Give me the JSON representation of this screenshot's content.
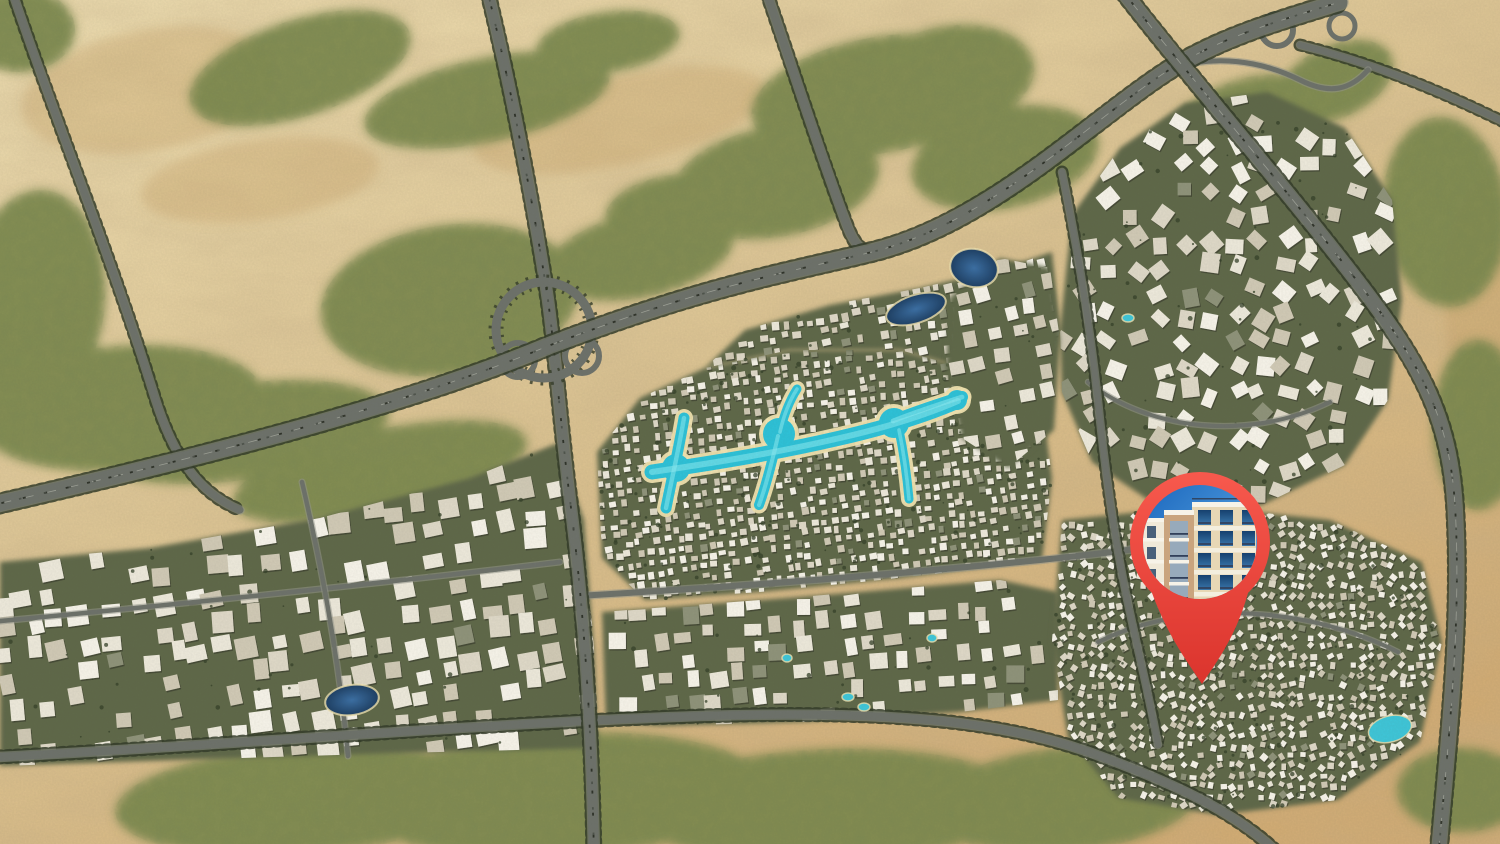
{
  "scene": {
    "width": 1500,
    "height": 844,
    "kind": "aerial-masterplan-map-with-location-pin"
  },
  "palette": {
    "sand_light": "#ecdcb0",
    "sand": "#dcc493",
    "sand_deep": "#d0ab74",
    "dune_shadow": "#c19a64",
    "veg": "#7e8a50",
    "veg_dark": "#55633a",
    "tree": "#36422a",
    "ground": "#5f6849",
    "road": "#6d716a",
    "road_edge": "#93968b",
    "treeline": "#343c29",
    "lane": "#c2c4b8",
    "traffic_a": "#24281f",
    "traffic_b": "#4a4f46",
    "bldg": [
      "#f4f1e7",
      "#ebe7d9",
      "#ddd7c6",
      "#cfc8b4"
    ],
    "bldg_dark": "#8e9279",
    "lagoon": "#2ec0d6",
    "lagoon_light": "#8ceaf0",
    "beach": "#eee0ae",
    "pool": "#3fc4d6",
    "pin_top": "#f7594d",
    "pin_bottom": "#da332c"
  },
  "marker": {
    "name": "project-location-pin",
    "head_cx": 1200,
    "head_cy": 542,
    "head_r": 70,
    "photo_r": 57,
    "tail_tip_x": 1202,
    "tail_tip_y": 684,
    "photo": {
      "subject": "beige-apartment-building-photo",
      "sky_top": "#1a66bd",
      "sky_bottom": "#6ab6ec",
      "facade": "#e7d7b5",
      "facade_light": "#f0e9d8",
      "band": "#f3eede",
      "portal": "#c9a47e",
      "opening": "#97aabb",
      "window_top": "#16406e",
      "window_bottom": "#3a77ab",
      "rail": "#31405a",
      "parapet": "#f7f3e8",
      "side_window": "#49607a"
    }
  },
  "terrain": {
    "green_patches": [
      [
        120,
        408,
        145,
        62,
        -5
      ],
      [
        35,
        300,
        70,
        110,
        5
      ],
      [
        300,
        68,
        115,
        48,
        -18
      ],
      [
        487,
        100,
        125,
        42,
        -12
      ],
      [
        608,
        42,
        72,
        30,
        -8
      ],
      [
        950,
        78,
        85,
        52,
        -10
      ],
      [
        880,
        95,
        130,
        58,
        -10
      ],
      [
        775,
        182,
        105,
        55,
        -10
      ],
      [
        1005,
        158,
        95,
        50,
        -12
      ],
      [
        680,
        212,
        75,
        38,
        -6
      ],
      [
        640,
        255,
        95,
        42,
        -12
      ],
      [
        450,
        300,
        130,
        75,
        -8
      ],
      [
        240,
        432,
        150,
        48,
        -8
      ],
      [
        380,
        472,
        150,
        42,
        -12
      ],
      [
        1245,
        128,
        85,
        48,
        -20
      ],
      [
        1335,
        82,
        62,
        36,
        -25
      ],
      [
        1200,
        200,
        70,
        45,
        -20
      ],
      [
        1445,
        212,
        62,
        95,
        -5
      ],
      [
        1478,
        425,
        45,
        85,
        0
      ],
      [
        300,
        800,
        185,
        55,
        -4
      ],
      [
        560,
        795,
        205,
        62,
        -3
      ],
      [
        830,
        806,
        195,
        57,
        -2
      ],
      [
        1065,
        800,
        135,
        52,
        -5
      ],
      [
        90,
        692,
        65,
        32,
        0
      ],
      [
        1462,
        790,
        65,
        42,
        0
      ],
      [
        20,
        30,
        55,
        42,
        0
      ]
    ],
    "dune_shadows": [
      [
        620,
        120,
        150,
        45,
        -12
      ],
      [
        260,
        180,
        120,
        40,
        -8
      ],
      [
        1485,
        300,
        40,
        120,
        0
      ],
      [
        150,
        90,
        130,
        60,
        -10
      ]
    ]
  },
  "roads": [
    {
      "id": "west-local-road",
      "d": "M -10 622 C 150 607, 350 587, 560 562",
      "w": 4.5,
      "t": 0,
      "tr": 0,
      "c": 0
    },
    {
      "id": "west-cross-road",
      "d": "M 302 482 C 320 560, 338 650, 348 756",
      "w": 4.5,
      "t": 0,
      "tr": 0,
      "c": 0
    },
    {
      "id": "east-ring-local",
      "d": "M 1088 382 C 1148 430, 1248 442, 1330 402",
      "w": 4,
      "t": 0,
      "tr": 0,
      "c": 0
    },
    {
      "id": "southeast-local",
      "d": "M 1098 642 C 1178 602, 1298 602, 1398 652",
      "w": 4,
      "t": 0,
      "tr": 0,
      "c": 0
    },
    {
      "id": "central-avenue",
      "d": "M 578 596 C 750 586, 900 574, 1040 560 C 1108 553, 1168 546, 1228 533",
      "w": 6,
      "t": 0,
      "tr": 0,
      "c": 0
    },
    {
      "id": "east-connector",
      "d": "M 1062 172 C 1080 260, 1092 340, 1100 420 C 1108 495, 1118 560, 1132 622 C 1142 668, 1150 700, 1158 745",
      "w": 6,
      "t": 1,
      "tr": 0,
      "c": 0
    },
    {
      "id": "boundary-road-south",
      "d": "M -20 758 C 250 744, 470 724, 700 716 C 900 710, 1012 722, 1105 758 C 1185 788, 1245 818, 1285 860",
      "w": 8,
      "t": 1,
      "tr": 0,
      "c": 0
    },
    {
      "id": "desert-road-northwest",
      "d": "M 10 -15 C 55 120, 112 258, 155 398 C 172 452, 196 492, 240 510",
      "w": 7,
      "t": 1,
      "tr": 0,
      "c": 0
    },
    {
      "id": "axis-road-north",
      "d": "M 764 -15 C 790 60, 822 160, 848 228 C 855 245, 862 252, 872 252",
      "w": 8,
      "t": 1,
      "tr": 0,
      "c": 0
    },
    {
      "id": "axis-road-interchange",
      "d": "M 486 -15 C 512 90, 536 220, 548 300 C 556 360, 560 420, 570 500 C 584 610, 592 730, 594 860",
      "w": 10,
      "t": 1,
      "tr": 1,
      "c": 0
    },
    {
      "id": "northeast-spur",
      "d": "M 1300 45 C 1380 65, 1450 95, 1520 130",
      "w": 6,
      "t": 1,
      "tr": 0,
      "c": 0
    },
    {
      "id": "ring-road-north",
      "d": "M -20 508 C 180 462, 400 408, 548 346 C 705 286, 790 272, 872 252 C 990 223, 1090 120, 1172 68 C 1225 36, 1275 22, 1340 2",
      "w": 15,
      "t": 1,
      "tr": 1,
      "c": 1
    },
    {
      "id": "highway-east",
      "d": "M 1118 -15 C 1198 88, 1298 202, 1370 298 C 1430 378, 1450 430, 1455 505 C 1462 625, 1448 742, 1438 860",
      "w": 13,
      "t": 1,
      "tr": 1,
      "c": 1
    }
  ],
  "interchanges": {
    "ring": {
      "cx": 544,
      "cy": 330,
      "r": 48,
      "w": 9
    },
    "loops": [
      {
        "cx": 518,
        "cy": 360,
        "r": 17,
        "w": 6
      },
      {
        "cx": 582,
        "cy": 356,
        "r": 17,
        "w": 6
      },
      {
        "cx": 1277,
        "cy": 30,
        "r": 16,
        "w": 6
      },
      {
        "cx": 1342,
        "cy": 26,
        "r": 13,
        "w": 5
      }
    ],
    "ramps": [
      {
        "id": "northeast-ramp",
        "d": "M 1172 68 C 1215 55, 1260 60, 1300 80 C 1330 95, 1350 90, 1368 70",
        "w": 5
      }
    ]
  },
  "districts": [
    {
      "id": "west-apartments",
      "seed": 11,
      "rot": -9,
      "spacing": 27,
      "size": [
        12,
        22
      ],
      "skip": 0.22,
      "trees": 0.8,
      "poly": [
        [
          0,
          562
        ],
        [
          150,
          548
        ],
        [
          320,
          518
        ],
        [
          470,
          478
        ],
        [
          558,
          443
        ],
        [
          584,
          520
        ],
        [
          594,
          648
        ],
        [
          598,
          748
        ],
        [
          400,
          753
        ],
        [
          180,
          760
        ],
        [
          0,
          766
        ]
      ]
    },
    {
      "id": "central-lagoon-villas",
      "seed": 22,
      "rot": -7,
      "spacing": 10.5,
      "size": [
        4.5,
        7.5
      ],
      "skip": 0.14,
      "trees": 0.5,
      "poly": [
        [
          597,
          452
        ],
        [
          640,
          398
        ],
        [
          705,
          368
        ],
        [
          790,
          350
        ],
        [
          900,
          350
        ],
        [
          1000,
          378
        ],
        [
          1042,
          402
        ],
        [
          1052,
          478
        ],
        [
          1042,
          560
        ],
        [
          900,
          578
        ],
        [
          760,
          592
        ],
        [
          645,
          600
        ],
        [
          602,
          558
        ]
      ]
    },
    {
      "id": "north-strip-villas",
      "seed": 77,
      "rot": -9,
      "spacing": 12,
      "size": [
        5,
        9
      ],
      "skip": 0.25,
      "trees": 0.6,
      "poly": [
        [
          705,
          368
        ],
        [
          745,
          330
        ],
        [
          830,
          305
        ],
        [
          920,
          288
        ],
        [
          1005,
          268
        ],
        [
          1052,
          252
        ],
        [
          1060,
          330
        ],
        [
          1042,
          402
        ],
        [
          1000,
          378
        ],
        [
          900,
          350
        ],
        [
          790,
          350
        ]
      ]
    },
    {
      "id": "south-central-apartments",
      "seed": 33,
      "rot": -5,
      "spacing": 23,
      "size": [
        10,
        18
      ],
      "skip": 0.25,
      "trees": 0.9,
      "poly": [
        [
          602,
          612
        ],
        [
          800,
          597
        ],
        [
          1000,
          580
        ],
        [
          1058,
          592
        ],
        [
          1058,
          700
        ],
        [
          960,
          712
        ],
        [
          800,
          722
        ],
        [
          660,
          726
        ],
        [
          606,
          722
        ]
      ]
    },
    {
      "id": "east-apartments",
      "seed": 44,
      "rot": 0,
      "scatter": true,
      "spacing": 25,
      "size": [
        11,
        20
      ],
      "skip": 0.2,
      "trees": 1.0,
      "poly": [
        [
          1060,
          330
        ],
        [
          1072,
          215
        ],
        [
          1120,
          148
        ],
        [
          1185,
          103
        ],
        [
          1268,
          92
        ],
        [
          1345,
          128
        ],
        [
          1392,
          200
        ],
        [
          1402,
          300
        ],
        [
          1388,
          400
        ],
        [
          1345,
          465
        ],
        [
          1262,
          505
        ],
        [
          1160,
          508
        ],
        [
          1092,
          462
        ],
        [
          1062,
          392
        ]
      ]
    },
    {
      "id": "business-cluster",
      "seed": 55,
      "rot": -12,
      "spacing": 21,
      "size": [
        10,
        16
      ],
      "skip": 0.3,
      "trees": 1.1,
      "poly": [
        [
          950,
          298
        ],
        [
          1000,
          258
        ],
        [
          1050,
          268
        ],
        [
          1060,
          340
        ],
        [
          1054,
          430
        ],
        [
          1008,
          468
        ],
        [
          962,
          438
        ],
        [
          946,
          368
        ]
      ]
    },
    {
      "id": "southeast-villas",
      "seed": 66,
      "rot": 0,
      "scatter": true,
      "spacing": 10,
      "size": [
        4.5,
        7
      ],
      "skip": 0.12,
      "trees": 0.5,
      "poly": [
        [
          1062,
          520
        ],
        [
          1200,
          506
        ],
        [
          1330,
          520
        ],
        [
          1422,
          562
        ],
        [
          1442,
          642
        ],
        [
          1420,
          742
        ],
        [
          1338,
          800
        ],
        [
          1218,
          815
        ],
        [
          1118,
          798
        ],
        [
          1068,
          738
        ],
        [
          1052,
          640
        ]
      ]
    }
  ],
  "water": {
    "lagoon_paths": [
      {
        "d": "M 652 472 C 720 462, 780 452, 840 438 C 888 427, 928 414, 958 401",
        "w": 15
      },
      {
        "d": "M 684 418 C 679 448, 672 478, 666 508",
        "w": 11
      },
      {
        "d": "M 778 436 C 772 462, 766 486, 759 505",
        "w": 10
      },
      {
        "d": "M 780 432 C 784 414, 790 400, 797 389",
        "w": 9
      },
      {
        "d": "M 893 421 C 915 412, 940 404, 962 397",
        "w": 12
      },
      {
        "d": "M 899 430 C 904 454, 907 477, 909 499",
        "w": 9
      }
    ],
    "lagoon_pools": [
      [
        676,
        468,
        14
      ],
      [
        779,
        434,
        16
      ],
      [
        894,
        423,
        15
      ],
      [
        957,
        400,
        10
      ]
    ],
    "lakes": [
      {
        "cx": 974,
        "cy": 268,
        "rx": 24,
        "ry": 19,
        "rot": 12
      },
      {
        "cx": 916,
        "cy": 309,
        "rx": 31,
        "ry": 14,
        "rot": -18
      },
      {
        "cx": 352,
        "cy": 700,
        "rx": 27,
        "ry": 15,
        "rot": -8
      }
    ],
    "small_pools": [
      [
        1390,
        729,
        22,
        13,
        -15
      ],
      [
        848,
        697,
        6,
        4,
        0
      ],
      [
        864,
        707,
        6,
        4,
        0
      ],
      [
        787,
        658,
        5,
        4,
        0
      ],
      [
        932,
        638,
        5,
        4,
        0
      ],
      [
        1128,
        318,
        6,
        4,
        0
      ]
    ]
  }
}
